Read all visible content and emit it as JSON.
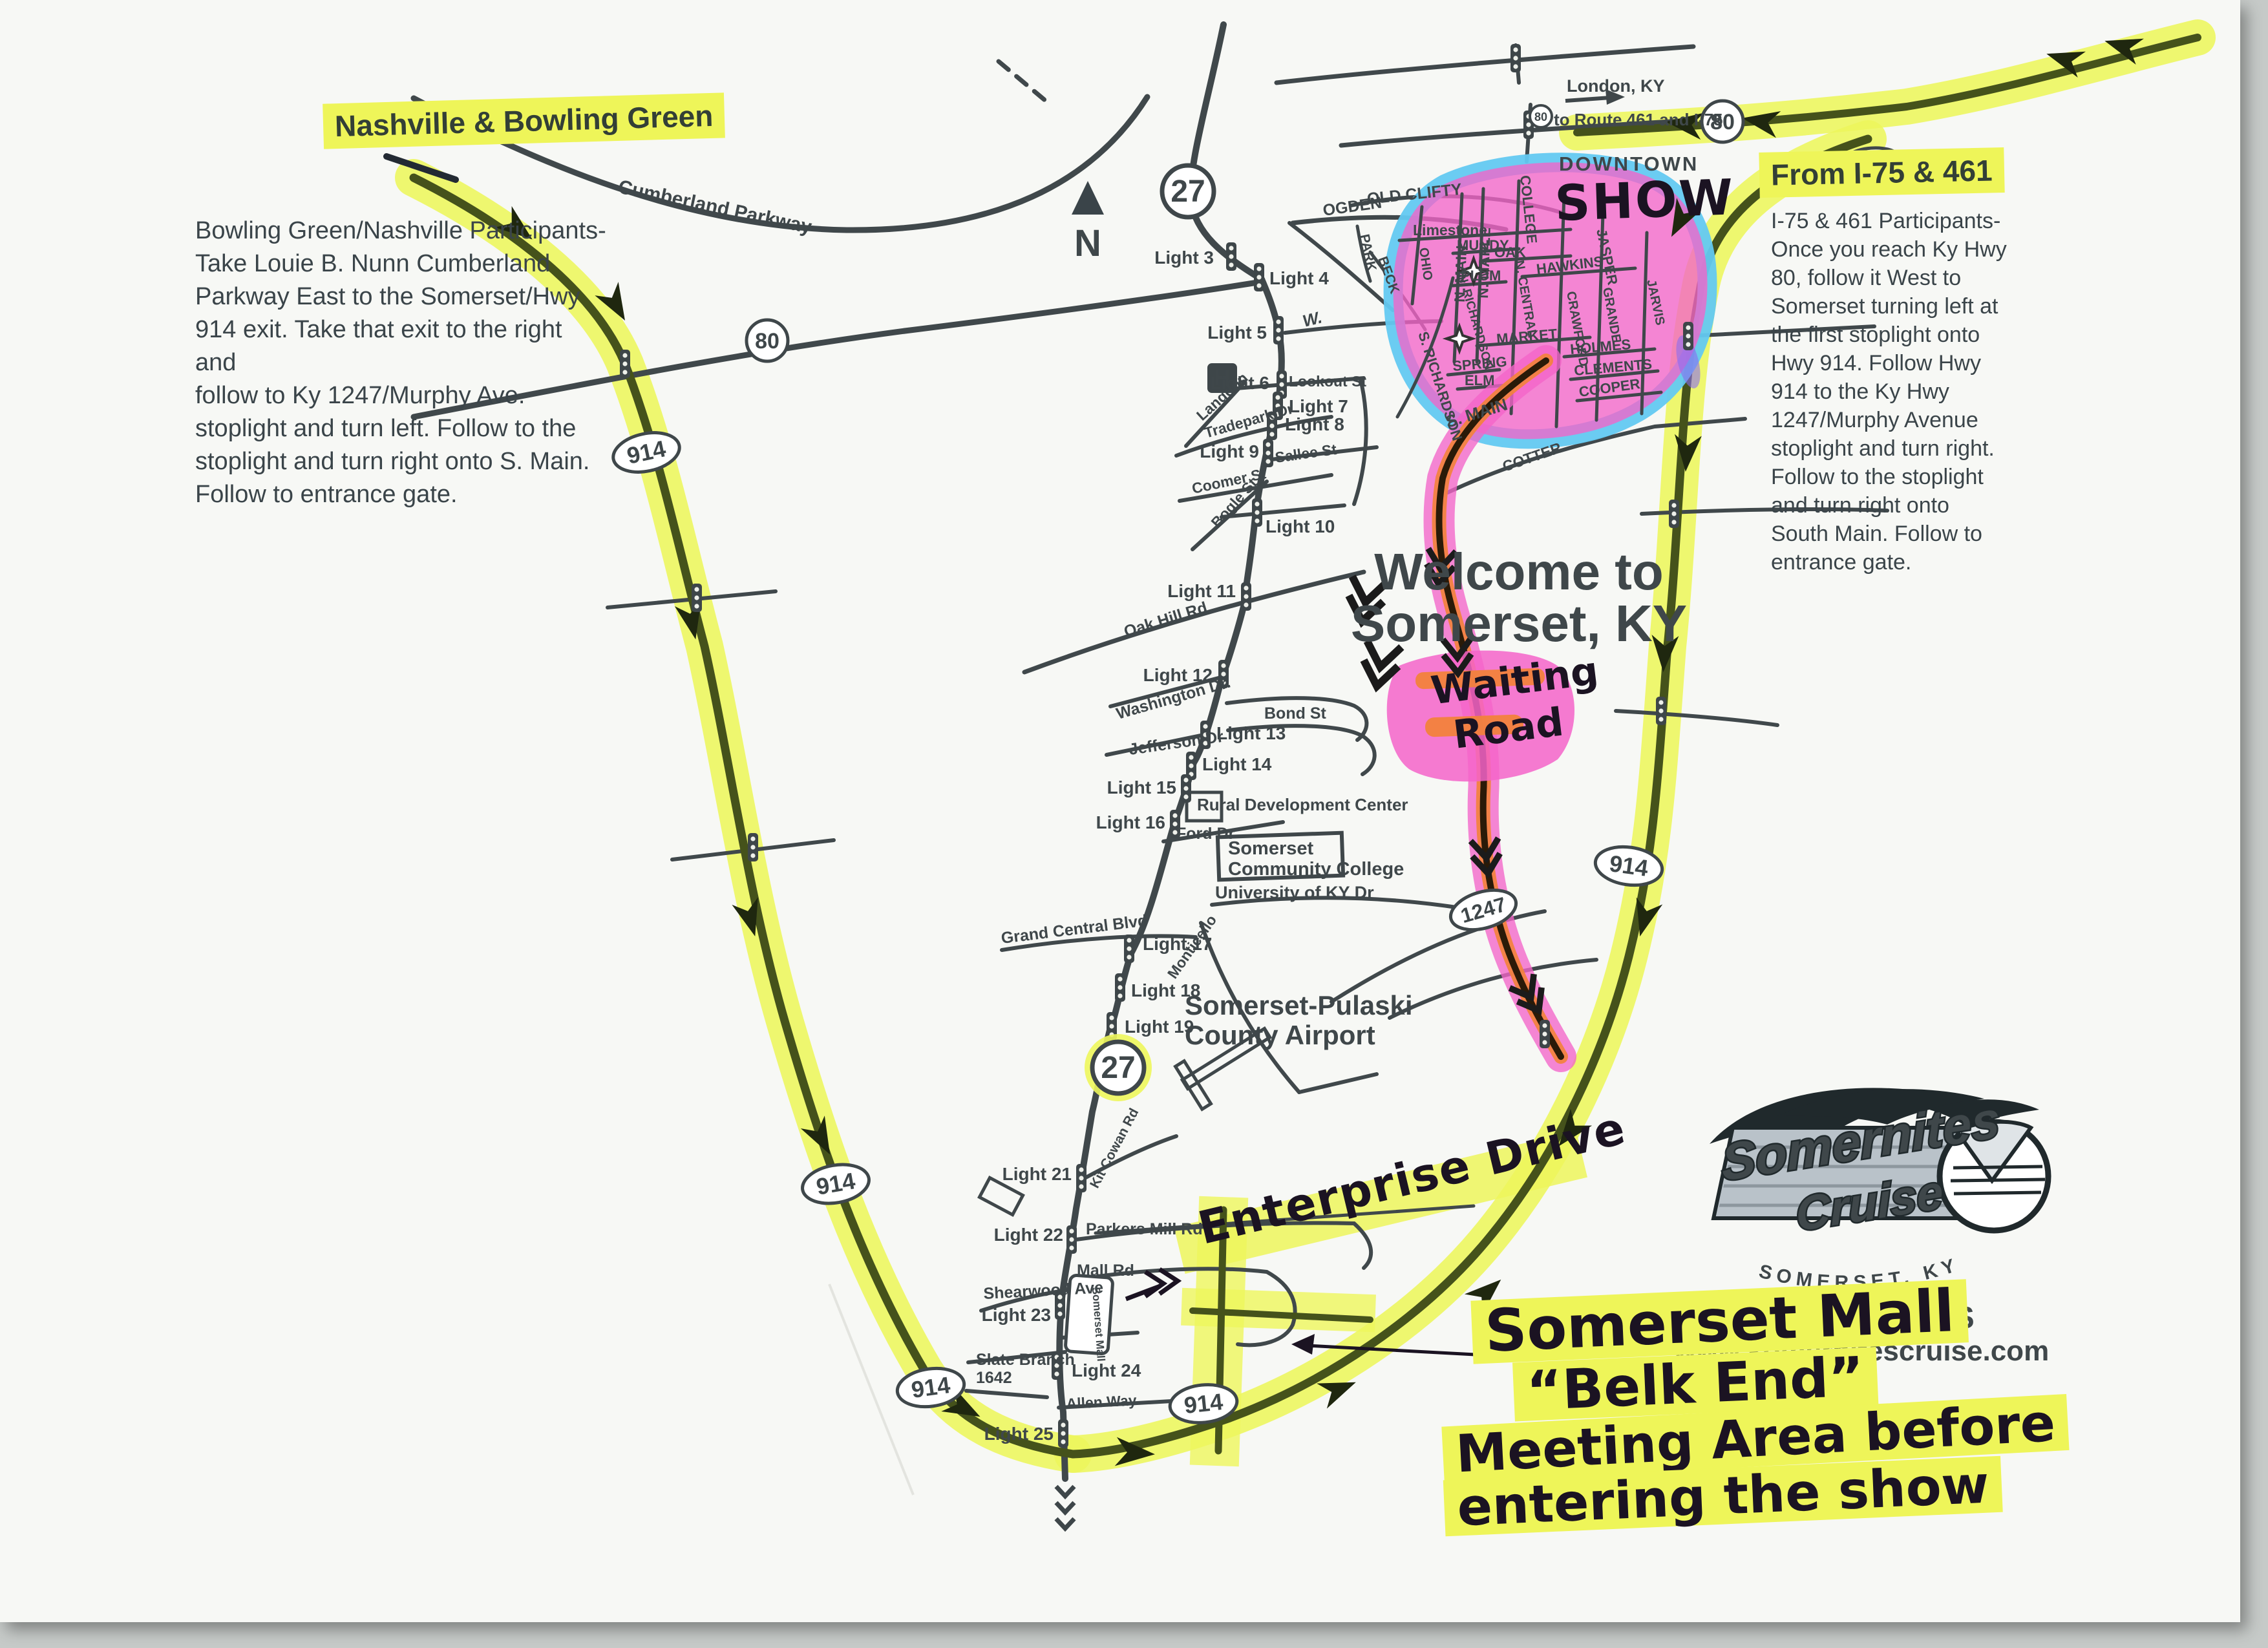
{
  "colors": {
    "highlight_yellow": "#eef559",
    "route_pink": "#f464c9",
    "route_orange": "#f2823c",
    "downtown_blue": "#63c9f1",
    "road_dark": "#40484b",
    "road_olive": "#45521b",
    "print_text": "#3a4449"
  },
  "icons": {
    "north_arrow": "north-arrow",
    "traffic_light": "traffic-light-icon",
    "hospital_letter": "H"
  },
  "headings": {
    "nashville": "Nashville & Bowling Green",
    "from_i75": "From I-75 & 461"
  },
  "directions_left": "Bowling Green/Nashville Participants-\nTake Louie B. Nunn Cumberland\nParkway East to the Somerset/Hwy\n914 exit.  Take that exit to the right and\nfollow to Ky 1247/Murphy Ave.\nstoplight and turn left.  Follow to the\nstoplight and turn right onto S. Main.\nFollow to entrance gate.",
  "directions_right": "I-75 & 461 Participants-\nOnce you reach Ky Hwy\n80, follow it West to\nSomerset turning left at\nthe first stoplight onto\nHwy 914.  Follow Hwy\n914 to the Ky Hwy\n1247/Murphy Avenue\nstoplight and turn right.\nFollow to the stoplight\nand turn right onto\nSouth Main.  Follow to\nentrance gate.",
  "welcome": {
    "line1": "Welcome to",
    "line2": "Somerset, KY"
  },
  "compass": {
    "label": "N"
  },
  "top_right": {
    "london": "London, KY",
    "route_note": "to Route 461 and I-75"
  },
  "downtown": {
    "label": "DOWNTOWN"
  },
  "handwritten": {
    "show": "SHOW",
    "waiting_line1": "Waiting",
    "waiting_line2": "Road",
    "enterprise": "Enterprise Drive",
    "mall_line1": "Somerset Mall",
    "mall_line2": "“Belk End”",
    "mall_line3": "Meeting Area before",
    "mall_line4": "entering the show"
  },
  "shields": {
    "s80": "80",
    "s27": "27",
    "s914": "914",
    "s1247": "1247"
  },
  "lights": {
    "l3": "Light 3",
    "l4": "Light 4",
    "l5": "Light 5",
    "l6": "Light 6",
    "l7": "Light 7",
    "l8": "Light 8",
    "l9": "Light 9",
    "l10": "Light 10",
    "l11": "Light 11",
    "l12": "Light 12",
    "l13": "Light 13",
    "l14": "Light 14",
    "l15": "Light 15",
    "l16": "Light 16",
    "l17": "Light 17",
    "l18": "Light 18",
    "l19": "Light 19",
    "l21": "Light 21",
    "l22": "Light 22",
    "l23": "Light 23",
    "l24": "Light 24",
    "l25": "Light 25"
  },
  "places": {
    "hospital": "H",
    "rural": "Rural Development Center",
    "college_l1": "Somerset",
    "college_l2": "Community College",
    "university": "University of KY Dr",
    "airport_l1": "Somerset-Pulaski",
    "airport_l2": "County Airport",
    "mall_box": "Somerset Mall"
  },
  "streets": {
    "cumberland": "Cumberland Parkway",
    "old_clifty": "OLD CLIFTY",
    "ogden": "OGDEN",
    "park": "PARK",
    "beck": "BECK",
    "ohio": "OHIO",
    "limestone": "Limestone",
    "n_main": "N. MAIN",
    "n_maple": "N. MAPLE",
    "mundy": "MUNDY",
    "oak": "OAK",
    "college": "COLLEGE",
    "plum": "PLUM",
    "n_central": "N. CENTRAL",
    "hawkins": "HAWKINS",
    "jasper": "JASPER",
    "grande": "GRANDE",
    "crawford": "CRAWFORD",
    "jarvis": "JARVIS",
    "n_richardson": "N. RICHARDSON",
    "s_richardson": "S. RICHARDSON",
    "market": "MARKET",
    "spring": "SPRING",
    "elm": "ELM",
    "holmes": "HOLMES",
    "clements": "CLEMENTS",
    "cooper": "COOPER",
    "cotter": "COTTER",
    "s_main": "S. MAIN",
    "w": "W.",
    "lookout": "Lookout St",
    "langdon": "Langdon",
    "tradepark": "Tradepark Dr",
    "sallee": "Sallee St",
    "coomer": "Coomer St",
    "bogle": "Bogle St",
    "oak_hill": "Oak Hill Rd",
    "washington": "Washington Dr.",
    "jefferson": "Jefferson Dr",
    "bond": "Bond St",
    "ford": "Ford Dr",
    "grand_central": "Grand Central Blvd",
    "monticello": "Monticello",
    "kit_cowan": "Kit Cowan Rd",
    "parkers_mill": "Parkers Mill Rd",
    "mall_rd": "Mall Rd",
    "shearwood": "Shearwood Ave",
    "slate_branch": "Slate Branch",
    "r1642": "1642",
    "allen_way": "Allen Way"
  },
  "logo": {
    "name_line1": "Somernites",
    "name_line2": "Cruise",
    "city": "SOMERSET, KY",
    "phone": "606-USA-CARS",
    "site": "www.somernitescruise.com"
  }
}
